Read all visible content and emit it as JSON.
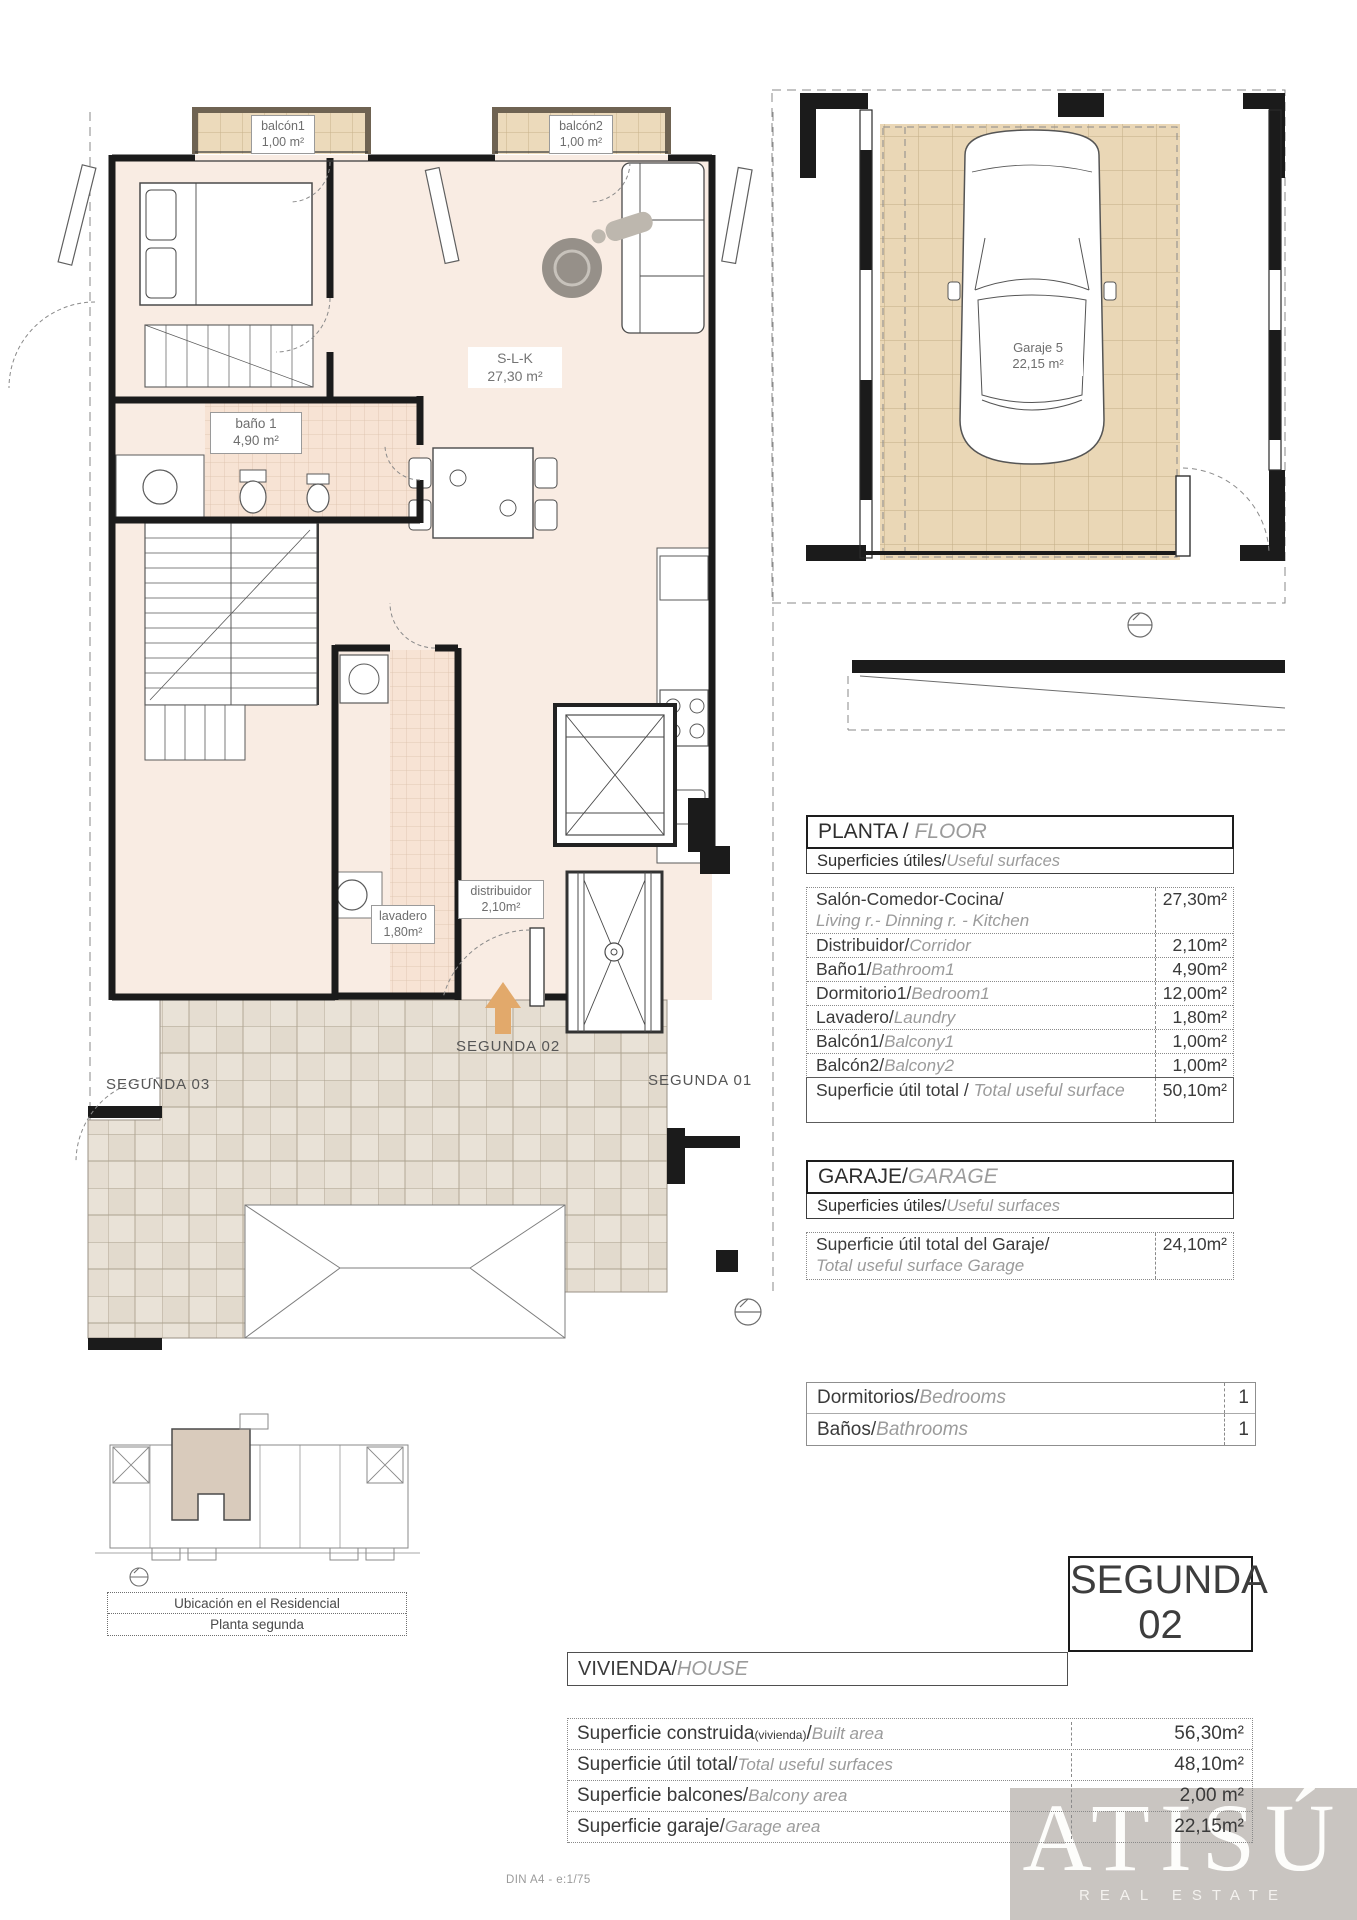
{
  "main_plan": {
    "balcony1": {
      "label": "balcón1",
      "area": "1,00 m²"
    },
    "balcony2": {
      "label": "balcón2",
      "area": "1,00 m²"
    },
    "living": {
      "label": "S-L-K",
      "area": "27,30 m²"
    },
    "bath": {
      "label": "baño 1",
      "area": "4,90 m²"
    },
    "laundry": {
      "label": "lavadero",
      "area": "1,80m²"
    },
    "hall": {
      "label": "distribuidor",
      "area": "2,10m²"
    },
    "entry_label": "SEGUNDA 02",
    "neighbor_left": "SEGUNDA 03",
    "neighbor_right": "SEGUNDA 01",
    "arrow_color": "#e2a96b"
  },
  "garage_plan": {
    "stall": {
      "label": "Garaje 5",
      "area": "22,15 m²"
    }
  },
  "floor_table": {
    "title": "PLANTA / ",
    "title_en": "FLOOR",
    "subtitle": "Superficies útiles/",
    "subtitle_en": "Useful surfaces",
    "rows": [
      {
        "es": "Salón-Comedor-Cocina/",
        "en": "Living r.- Dinning r. - Kitchen",
        "value": "27,30m²"
      },
      {
        "es": "Distribuidor/",
        "en": "Corridor",
        "value": "2,10m²"
      },
      {
        "es": "Baño1/",
        "en": "Bathroom1",
        "value": "4,90m²"
      },
      {
        "es": "Dormitorio1/",
        "en": "Bedroom1",
        "value": "12,00m²"
      },
      {
        "es": "Lavadero/",
        "en": "Laundry",
        "value": "1,80m²"
      },
      {
        "es": "Balcón1/",
        "en": "Balcony1",
        "value": "1,00m²"
      },
      {
        "es": "Balcón2/",
        "en": "Balcony2",
        "value": "1,00m²"
      }
    ],
    "total": {
      "es": "Superficie útil total / ",
      "en": "Total useful surface",
      "value": "50,10m²"
    }
  },
  "garage_table": {
    "title": "GARAJE/",
    "title_en": "GARAGE",
    "subtitle": "Superficies útiles/",
    "subtitle_en": "Useful surfaces",
    "row": {
      "es": "Superficie útil total del Garaje/",
      "en": "Total useful surface Garage",
      "value": "24,10m²"
    }
  },
  "rooms_table": {
    "rows": [
      {
        "es": "Dormitorios/",
        "en": "Bedrooms",
        "value": "1"
      },
      {
        "es": "Baños/",
        "en": "Bathrooms",
        "value": "1"
      }
    ]
  },
  "unit_badge": {
    "line1": "SEGUNDA",
    "line2": "02"
  },
  "house_table": {
    "title": "VIVIENDA/",
    "title_en": "HOUSE",
    "rows": [
      {
        "es": "Superficie construida",
        "note": "(vivienda)",
        "sep": "/",
        "en": "Built area",
        "value": "56,30m²"
      },
      {
        "es": "Superficie útil total",
        "note": "",
        "sep": "/",
        "en": "Total useful surfaces",
        "value": "48,10m²"
      },
      {
        "es": "Superficie balcones",
        "note": "",
        "sep": "/",
        "en": "Balcony area",
        "value": "2,00 m²"
      },
      {
        "es": "Superficie garaje",
        "note": "",
        "sep": "/",
        "en": "Garage area",
        "value": "22,15m²"
      }
    ]
  },
  "location": {
    "line1": "Ubicación en el Residencial",
    "line2": "Planta segunda"
  },
  "page": {
    "footer_note": "DIN A4 - e:1/75"
  },
  "logo": {
    "name": "ATISÚ",
    "tagline": "REAL ESTATE"
  }
}
